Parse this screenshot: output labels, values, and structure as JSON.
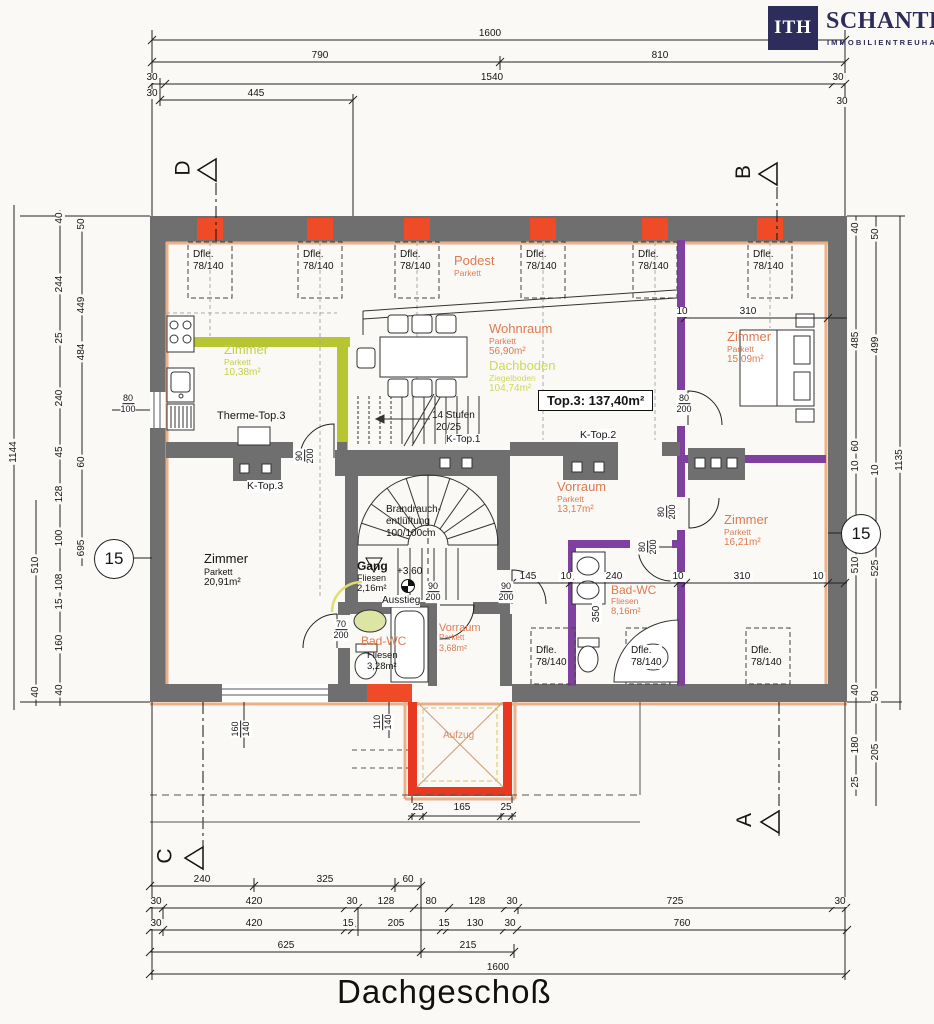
{
  "logo": {
    "mark": "ITH",
    "name": "SCHANTL",
    "subtitle": "IMMOBILIENTREUHAND"
  },
  "title": "Dachgeschoß",
  "unit_label": "Top.3:  137,40m²",
  "markers": {
    "d": "D",
    "b": "B",
    "c": "C",
    "a": "A"
  },
  "level_circle": "15",
  "rooms": {
    "z1038": {
      "name": "Zimmer",
      "floor": "Parkett",
      "area": "10,38m²"
    },
    "wohnraum": {
      "name": "Wohnraum",
      "floor": "Parkett",
      "area": "56,90m²"
    },
    "dachboden": {
      "name": "Dachboden",
      "floor": "Ziegelboden",
      "area": "104,74m²"
    },
    "podest": {
      "name": "Podest",
      "floor": "Parkett"
    },
    "z1509": {
      "name": "Zimmer",
      "floor": "Parkett",
      "area": "15,09m²"
    },
    "vorraum1": {
      "name": "Vorraum",
      "floor": "Parkett",
      "area": "13,17m²"
    },
    "z1621": {
      "name": "Zimmer",
      "floor": "Parkett",
      "area": "16,21m²"
    },
    "bad816": {
      "name": "Bad-WC",
      "floor": "Fliesen",
      "area": "8,16m²"
    },
    "z2091": {
      "name": "Zimmer",
      "floor": "Parkett",
      "area": "20,91m²"
    },
    "gang": {
      "name": "Gang",
      "floor": "Fliesen",
      "area": "2,16m²",
      "level": "+3,60",
      "exit": "Ausstieg"
    },
    "bad328": {
      "name": "Bad-WC",
      "floor": "Fliesen",
      "area": "3,28m²"
    },
    "vorraum2": {
      "name": "Vorraum",
      "floor": "Parkett",
      "area": "3,68m²"
    },
    "aufzug": {
      "name": "Aufzug"
    }
  },
  "labels": {
    "therme": "Therme-Top.3",
    "ktop1": "K-Top.1",
    "ktop2": "K-Top.2",
    "ktop3": "K-Top.3",
    "stufen1": "14  Stufen",
    "stufen2": "20/25",
    "vent1": "Brandrauch-",
    "vent2": "entlüftung",
    "vent3": "100/100cm",
    "dfle1": "Dfle.",
    "dfle2": "78/140"
  },
  "doors": {
    "d70": [
      "70",
      "200"
    ],
    "d80": [
      "80",
      "200"
    ],
    "d90": [
      "90",
      "200"
    ],
    "w80": [
      "80",
      "100"
    ],
    "w160": [
      "160",
      "140"
    ],
    "w110": [
      "110",
      "140"
    ]
  },
  "dims": {
    "top": {
      "total": "1600",
      "a": "790",
      "b": "810",
      "c": "30",
      "d": "1540",
      "e": "30",
      "f": "30",
      "g": "445",
      "h": "30"
    },
    "bottom": {
      "r1": [
        "240",
        "325",
        "60"
      ],
      "r2": [
        "30",
        "420",
        "30",
        "128",
        "80",
        "128",
        "30",
        "725",
        "30"
      ],
      "r3": [
        "30",
        "420",
        "15",
        "205",
        "15",
        "130",
        "30",
        "760"
      ],
      "r4": [
        "625",
        "215"
      ],
      "total": "1600"
    },
    "left": {
      "total": "1144",
      "mid": "510",
      "mid2": "40",
      "chain": [
        "40",
        "244",
        "25",
        "240",
        "45",
        "128",
        "100",
        "108",
        "15",
        "160",
        "40"
      ],
      "inner": [
        "50",
        "449",
        "484",
        "60",
        "695"
      ]
    },
    "right": {
      "total": "1135",
      "chain": [
        "40",
        "485",
        "60",
        "10",
        "510",
        "40",
        "180",
        "25"
      ],
      "inner": [
        "50",
        "499",
        "10",
        "525",
        "50",
        "205"
      ]
    },
    "inner": {
      "a": "145",
      "b": "10",
      "c": "240",
      "d": "10",
      "e": "310",
      "f": "10",
      "g": "10",
      "h": "310",
      "i": "350"
    },
    "lift": [
      "25",
      "165",
      "25"
    ]
  },
  "colors": {
    "wall": "#6f6f6f",
    "accent": "#ee4b26",
    "purple": "#8040a0",
    "green_wall": "#b6c531",
    "lining": "#eab089",
    "brand": "#2d2c5a"
  }
}
